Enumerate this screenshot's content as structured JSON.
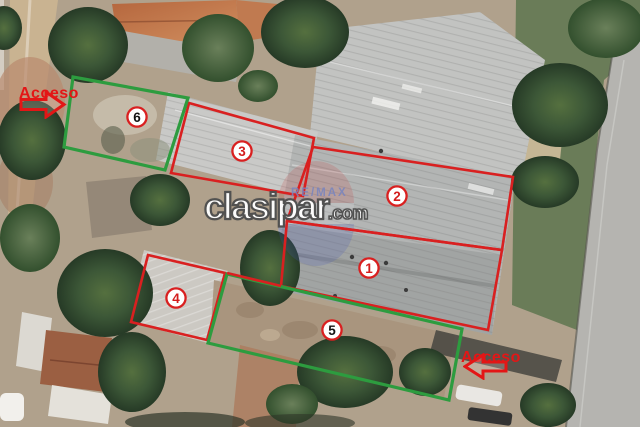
{
  "watermark": {
    "main": "clasipar",
    "suffix": ".com",
    "remax": "RE/MAX"
  },
  "access": {
    "top_left": {
      "text": "Acceso",
      "arrow_direction": "right"
    },
    "bottom_right": {
      "text": "Acceso",
      "arrow_direction": "left"
    }
  },
  "annotation_colors": {
    "red": "#d92020",
    "green": "#2d9c3f",
    "badge_ring": "#d92020",
    "badge_fill": "#ffffff",
    "digit_red": "#d31d1d",
    "digit_black": "#141414",
    "access_text": "#e31616"
  },
  "regions": [
    {
      "number": "1",
      "outline_color": "red",
      "points": [
        [
          287,
          221
        ],
        [
          502,
          250
        ],
        [
          488,
          330
        ],
        [
          281,
          286
        ]
      ],
      "badge": {
        "x": 369,
        "y": 268,
        "digit": "red"
      }
    },
    {
      "number": "2",
      "outline_color": "red",
      "points": [
        [
          313,
          147
        ],
        [
          513,
          177
        ],
        [
          502,
          250
        ],
        [
          287,
          221
        ]
      ],
      "badge": {
        "x": 397,
        "y": 196,
        "digit": "red"
      }
    },
    {
      "number": "3",
      "outline_color": "red",
      "points": [
        [
          189,
          103
        ],
        [
          314,
          138
        ],
        [
          303,
          196
        ],
        [
          171,
          173
        ]
      ],
      "badge": {
        "x": 242,
        "y": 151,
        "digit": "red"
      }
    },
    {
      "number": "4",
      "outline_color": "red",
      "points": [
        [
          148,
          255
        ],
        [
          225,
          273
        ],
        [
          207,
          340
        ],
        [
          131,
          322
        ]
      ],
      "badge": {
        "x": 176,
        "y": 298,
        "digit": "red"
      }
    },
    {
      "number": "5",
      "outline_color": "green",
      "points": [
        [
          227,
          274
        ],
        [
          462,
          329
        ],
        [
          449,
          400
        ],
        [
          208,
          343
        ]
      ],
      "badge": {
        "x": 332,
        "y": 330,
        "digit": "black"
      }
    },
    {
      "number": "6",
      "outline_color": "green",
      "points": [
        [
          73,
          77
        ],
        [
          188,
          98
        ],
        [
          165,
          170
        ],
        [
          64,
          147
        ]
      ],
      "badge": {
        "x": 137,
        "y": 117,
        "digit": "black"
      }
    }
  ],
  "connector_lines": [
    {
      "color": "red",
      "points": [
        [
          227,
          273
        ],
        [
          281,
          286
        ]
      ]
    }
  ]
}
